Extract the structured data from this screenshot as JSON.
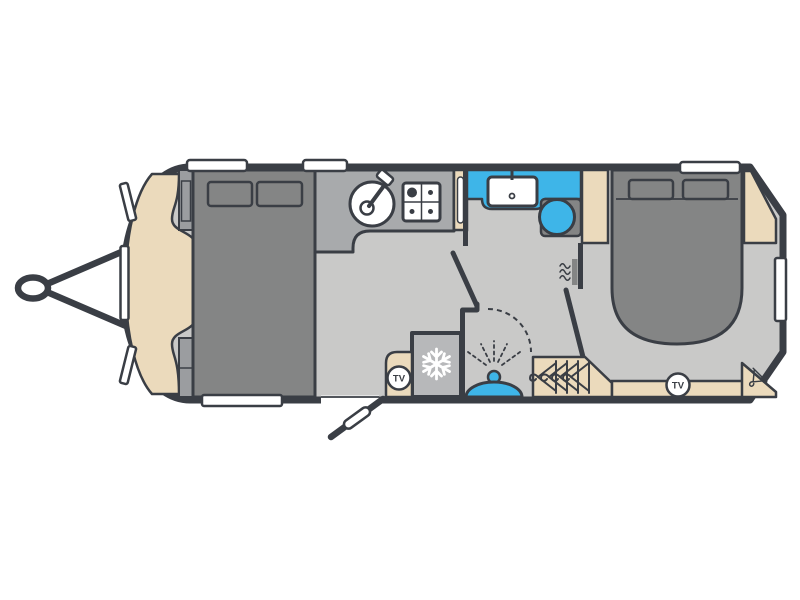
{
  "title": "caravan-floorplan",
  "labels": {
    "tv": "TV"
  },
  "colors": {
    "outline": "#3a3e45",
    "floor": "#c9c9c8",
    "bed": "#848585",
    "worktop": "#a8aaac",
    "beige": "#ebdabc",
    "blue": "#3eb5e8",
    "fridge": "#b7b8ba",
    "strip": "#9b9da0",
    "white": "#ffffff"
  },
  "rooms": [
    "front-lounge-bed",
    "kitchen",
    "washroom",
    "shower",
    "rear-island-bed-bedroom"
  ],
  "icons": [
    "tow-hitch",
    "kitchen-sink-tap",
    "hob-burners",
    "washbasin-tap",
    "toilet",
    "heater",
    "shower-head-spray",
    "fridge-snowflake",
    "tv-point",
    "wardrobe-hangers",
    "corner-wardrobe-hanger",
    "entry-door"
  ]
}
